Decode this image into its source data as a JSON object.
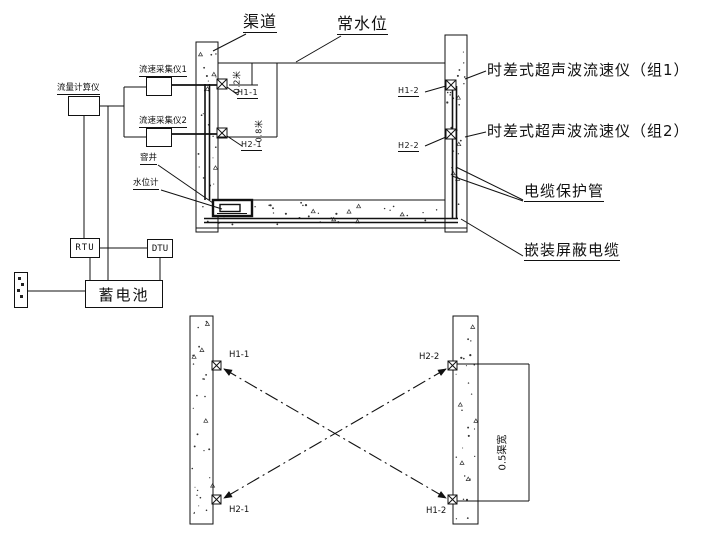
{
  "section": {
    "channel": "渠道",
    "normal_water_level": "常水位",
    "dim_top": "0.2米",
    "dim_bottom": "0.8米",
    "h1_1": "H1-1",
    "h2_1": "H2-1",
    "h1_2": "H1-2",
    "h2_2": "H2-2",
    "well": "窨井",
    "water_level_gauge": "水位计",
    "group1": "时差式超声波流速仪（组1）",
    "group2": "时差式超声波流速仪（组2）",
    "cable_pipe": "电缆保护管",
    "shielded_cable": "嵌装屏蔽电缆"
  },
  "equipment": {
    "flow_calculator": "流量计算仪",
    "velocity_collector_1": "流速采集仪1",
    "velocity_collector_2": "流速采集仪2",
    "rtu": "RTU",
    "dtu": "DTU",
    "battery": "蓄电池"
  },
  "plan": {
    "h1_1": "H1-1",
    "h2_2": "H2-2",
    "h2_1": "H2-1",
    "h1_2": "H1-2",
    "dim_spacing": "0.5渠宽"
  },
  "colors": {
    "ink": "#111111",
    "paper": "#ffffff"
  }
}
